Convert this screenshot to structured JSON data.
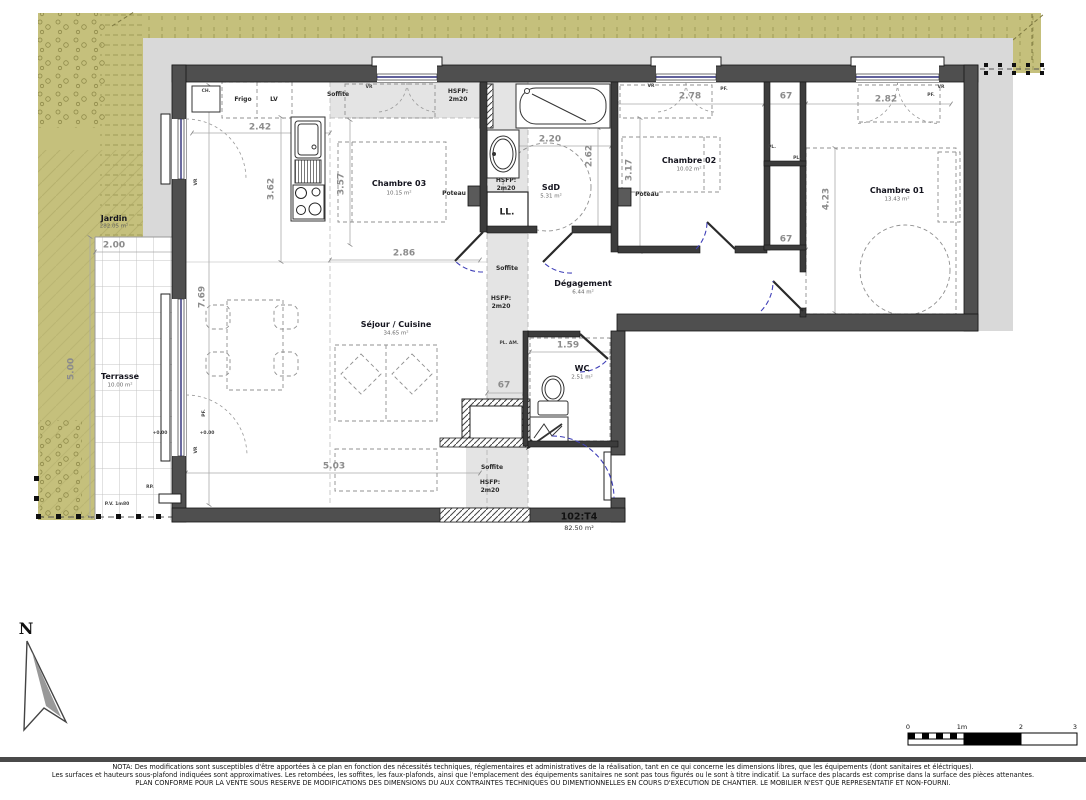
{
  "unit": {
    "code": "102:T4",
    "area": "82.50 m²"
  },
  "north": {
    "letter": "N"
  },
  "rooms": {
    "chambre03": {
      "name": "Chambre 03",
      "area": "10.15 m²"
    },
    "sdd": {
      "name": "SdD",
      "area": "5.31 m²"
    },
    "chambre02": {
      "name": "Chambre 02",
      "area": "10.02 m²"
    },
    "chambre01": {
      "name": "Chambre 01",
      "area": "13.43 m²"
    },
    "sejour": {
      "name": "Séjour / Cuisine",
      "area": "34.65 m²"
    },
    "degagement": {
      "name": "Dégagement",
      "area": "6.44 m²"
    },
    "wc": {
      "name": "WC",
      "area": "2.51 m²"
    },
    "terrasse": {
      "name": "Terrasse",
      "area": "10.00 m²"
    },
    "jardin": {
      "name": "Jardin",
      "area": "282.05 m²"
    }
  },
  "dims": {
    "kitchen_width": "2.42",
    "kitchen_depth": "3.62",
    "ch03_depth": "3.57",
    "ch03_width": "2.86",
    "sdd_width": "2.20",
    "sdd_depth": "2.62",
    "ch02_depth": "3.17",
    "ch02_width": "2.78",
    "placard_top": "67",
    "placard_bottom": "67",
    "ch01_width": "2.82",
    "ch01_depth": "4.23",
    "sejour_depth": "7.69",
    "sejour_width": "5.03",
    "wc_width": "1.59",
    "wc_placard": "67",
    "terrasse_width": "2.00",
    "terrasse_depth": "5.00"
  },
  "ann": {
    "ch": "CH.",
    "frigo": "Frigo",
    "lv": "LV",
    "soffite": "Soffite",
    "hsfp_line1": "HSFP:",
    "hsfp_line2": "2m20",
    "poteau": "Poteau",
    "ll": "LL.",
    "pl": "PL.",
    "pl_am": "PL. AM.",
    "vr": "VR",
    "pf": "PF.",
    "level": "+0.00",
    "pv": "P.V. 1m80",
    "rp": "RP."
  },
  "scalebar": {
    "t0": "0",
    "t1": "1m",
    "t2": "2",
    "t3": "3"
  },
  "notes": {
    "l1": "NOTA: Des modifications sont susceptibles d'être apportées à ce plan en fonction des nécessités techniques, réglementaires et administratives de la réalisation, tant en ce qui concerne les dimensions libres, que les équipements (dont sanitaires et éléctriques).",
    "l2": "Les surfaces et hauteurs sous-plafond indiquées sont approximatives. Les retombées, les soffites, les faux-plafonds, ainsi que l'emplacement des équipements sanitaires ne sont pas tous figurés ou le sont à titre indicatif. La surface des placards est comprise dans la surface des pièces attenantes.",
    "l3": "PLAN CONFORME POUR LA VENTE SOUS RESERVE DE MODIFICATIONS DES DIMENSIONS DU AUX CONTRAINTES TECHNIQUES OU DIMENTIONNELLES EN COURS D'EXECUTION DE CHANTIER. LE MOBILIER N'EST QUE REPRESENTATIF ET NON-FOURNI."
  },
  "colors": {
    "garden": "#c5c07c",
    "walkway": "#d9d9d9",
    "wall": "#4f4f4f",
    "soffit": "#e4e4e4",
    "door_swing": "#4040b8",
    "glazing": "#2c2c78",
    "dim_text": "#8c8c8c"
  }
}
